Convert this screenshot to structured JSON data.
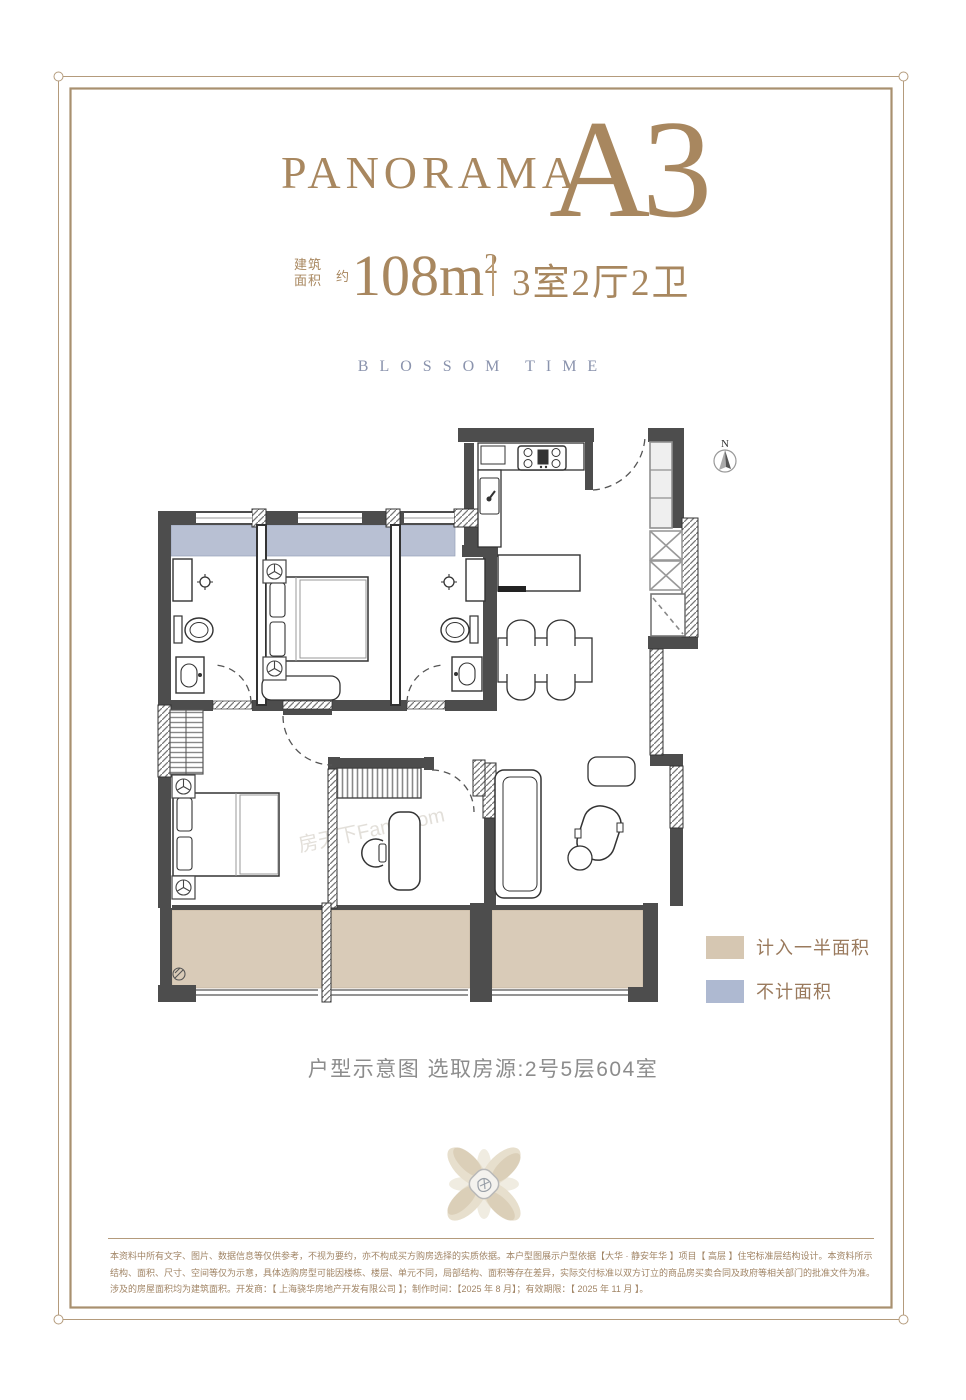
{
  "header": {
    "brand": "PANORAMA",
    "unit": "A3",
    "area_label_top": "建筑",
    "area_label_bottom": "面积",
    "area_approx": "约",
    "area_value": "108m",
    "area_sup": "2",
    "rooms": "3室2厅2卫",
    "subtitle": "BLOSSOM TIME",
    "accent_color": "#a8875f",
    "subtitle_color": "#8a93ad"
  },
  "plan": {
    "north_label": "N",
    "watermark": "房天下Fang.com",
    "colors": {
      "wall": "#4d4d4d",
      "half_area_fill": "#d9cbb8",
      "excluded_fill": "#b8c0d3"
    }
  },
  "legend": {
    "text_color": "#9a7a5d",
    "items": [
      {
        "label": "计入一半面积",
        "color": "#d6c7b2"
      },
      {
        "label": "不计面积",
        "color": "#aeb9d1"
      }
    ]
  },
  "caption": {
    "text": "户型示意图  选取房源:2号5层604室",
    "color": "#8c8c8c"
  },
  "frame": {
    "color": "#b49b7c"
  },
  "disclaimer": {
    "color": "#a18566",
    "lines": [
      "本资料中所有文字、图片、数据信息等仅供参考，不视为要约，亦不构成买方购房选择的实质依据。本户型图展示户型依据【大华 · 静安年华 】项目【 高层 】住宅标准层结构设计。本资料所示",
      "结构、面积、尺寸、空间等仅为示意，具体选购房型可能因楼栋、楼层、单元不同，局部结构、面积等存在差异，实际交付标准以双方订立的商品房买卖合同及政府等相关部门的批准文件为准。",
      "涉及的房屋面积均为建筑面积。开发商：【 上海骁华房地产开发有限公司 】；制作时间：【2025 年 8 月】；有效期限：【 2025 年 11 月 】。"
    ]
  }
}
